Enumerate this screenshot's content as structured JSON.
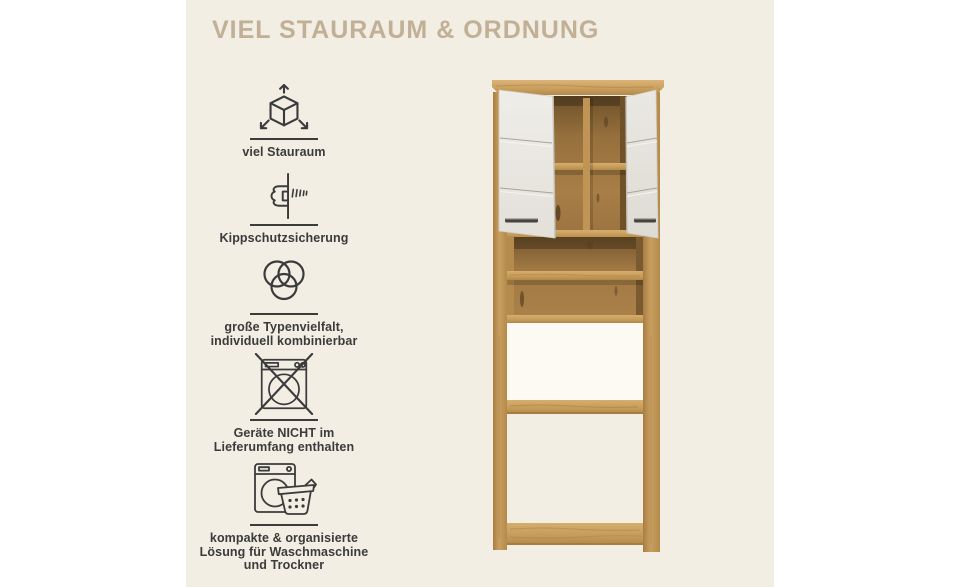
{
  "title": "VIEL STAURAUM & ORDNUNG",
  "features": [
    {
      "icon": "cube-dimensions-icon",
      "lines": [
        "viel Stauraum"
      ]
    },
    {
      "icon": "anti-tip-bracket-icon",
      "lines": [
        "Kippschutzsicherung"
      ]
    },
    {
      "icon": "venn-circles-icon",
      "lines": [
        "große Typenvielfalt,",
        "individuell kombinierbar"
      ]
    },
    {
      "icon": "crossed-washing-machine-icon",
      "lines": [
        "Geräte NICHT im",
        "Lieferumfang enthalten"
      ]
    },
    {
      "icon": "washer-and-basket-icon",
      "lines": [
        "kompakte & organisierte",
        "Lösung für Waschmaschine",
        "und Trockner"
      ]
    }
  ],
  "colors": {
    "page_background": "#ffffff",
    "panel_background": "#f2eee4",
    "title": "#c1b096",
    "text": "#3b3b3b",
    "wood": "#c79e5e",
    "wood_dark": "#8a6336",
    "door": "#e9e7e1",
    "handle": "#46443f"
  }
}
